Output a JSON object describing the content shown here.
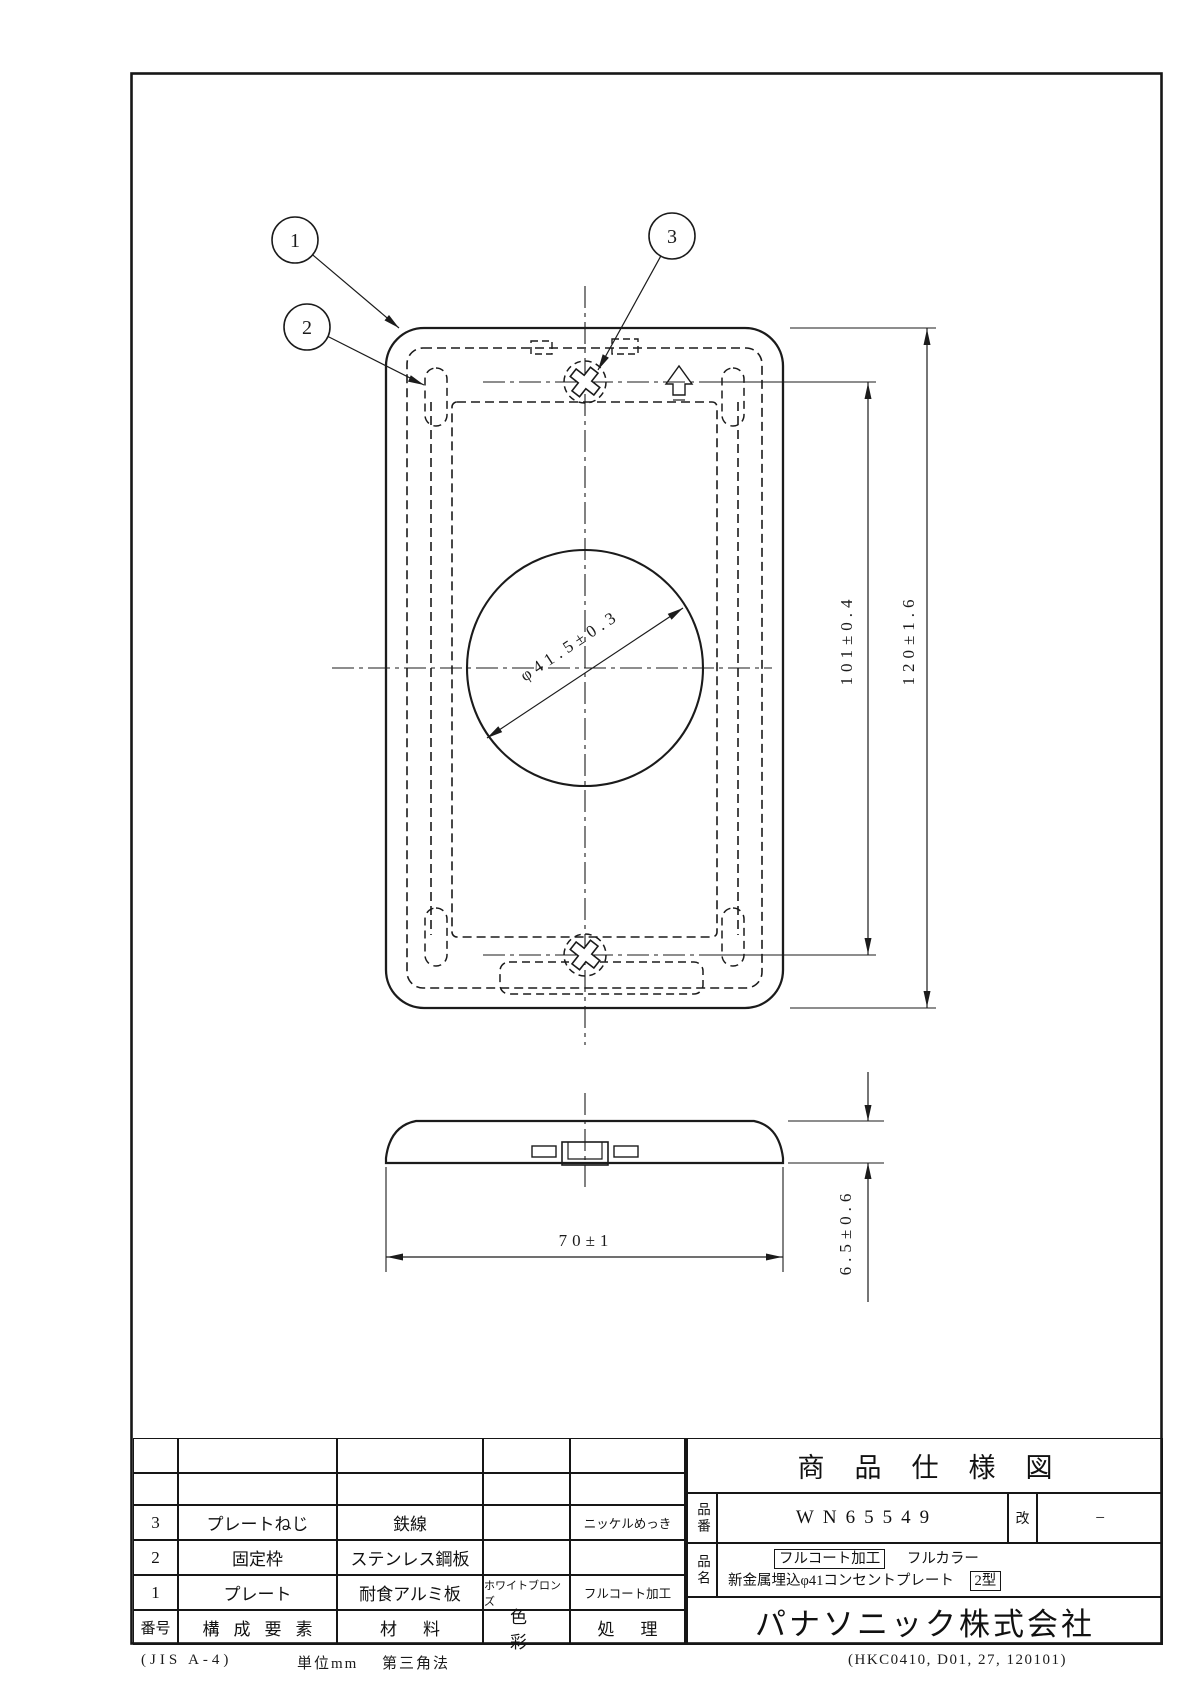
{
  "drawing": {
    "balloons": [
      {
        "label": "1"
      },
      {
        "label": "2"
      },
      {
        "label": "3"
      }
    ],
    "dimensions": {
      "hole_diameter": "φ41.5±0.3",
      "screw_pitch": "101±0.4",
      "plate_height": "120±1.6",
      "plate_width": "70±1",
      "plate_thickness": "6.5±0.6"
    }
  },
  "title_block": {
    "title": "商品仕様図",
    "part_number_label": "品番",
    "part_number": "WN65549",
    "revision_label": "改",
    "revision_value": "−",
    "product_name_label": "品名",
    "product_name_badge": "フルコート加工",
    "product_name_series": "フルカラー",
    "product_name": "新金属埋込φ41コンセントプレート",
    "product_type_badge": "2型",
    "company": "パナソニック株式会社"
  },
  "parts_table": {
    "headers": {
      "no": "番号",
      "component": "構成要素",
      "material": "材料",
      "color": "色彩",
      "process": "処理"
    },
    "rows": [
      {
        "no": "3",
        "component": "プレートねじ",
        "material": "鉄線",
        "color": "",
        "process": "ニッケルめっき"
      },
      {
        "no": "2",
        "component": "固定枠",
        "material": "ステンレス鋼板",
        "color": "",
        "process": ""
      },
      {
        "no": "1",
        "component": "プレート",
        "material": "耐食アルミ板",
        "color": "ホワイトブロンズ",
        "process": "フルコート加工"
      }
    ]
  },
  "footer": {
    "paper": "(JIS A-4)",
    "unit": "単位mm",
    "projection": "第三角法",
    "doc_code": "(HKC0410, D01, 27, 120101)"
  }
}
